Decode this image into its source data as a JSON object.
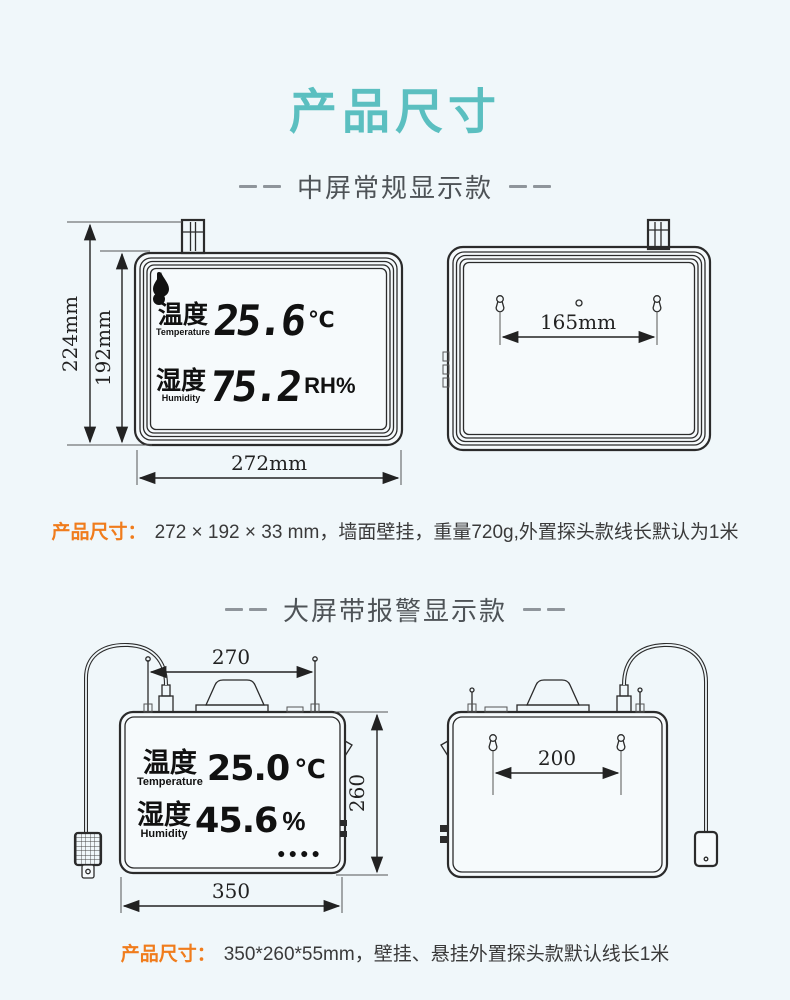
{
  "title": "产品尺寸",
  "colors": {
    "background": "#f0f7fa",
    "accent_teal": "#5bbfc0",
    "label_orange": "#f07c1c",
    "line": "#2b2b2b"
  },
  "sections": [
    {
      "header": "中屏常规显示款",
      "spec_label": "产品尺寸：",
      "spec_text": "272 × 192 × 33 mm，墙面壁挂，重量720g,外置探头款线长默认为1米",
      "display": {
        "temp_label_zh": "温度",
        "temp_label_en": "Temperature",
        "temp_value": "25.6",
        "temp_unit": "℃",
        "hum_label_zh": "湿度",
        "hum_label_en": "Humidity",
        "hum_value": "75.2",
        "hum_unit": "RH%"
      },
      "dims": {
        "outer_height": "224mm",
        "body_height": "192mm",
        "body_width": "272mm",
        "mount_spacing": "165mm"
      }
    },
    {
      "header": "大屏带报警显示款",
      "spec_label": "产品尺寸：",
      "spec_text": "350*260*55mm，壁挂、悬挂外置探头款默认线长1米",
      "display": {
        "temp_label_zh": "温度",
        "temp_label_en": "Temperature",
        "temp_value": "25.0",
        "temp_unit": "℃",
        "hum_label_zh": "湿度",
        "hum_label_en": "Humidity",
        "hum_value": "45.6",
        "hum_unit": "%",
        "alarm_dots": "●●●●"
      },
      "dims": {
        "top_width": "270",
        "body_height": "260",
        "body_width": "350",
        "mount_spacing": "200"
      }
    }
  ]
}
